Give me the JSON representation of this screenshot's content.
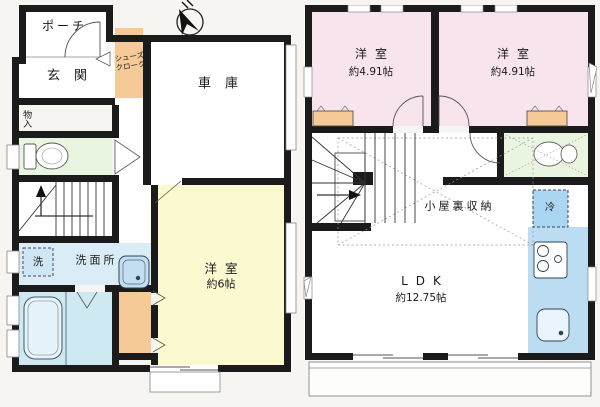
{
  "title": "住宅間取り図(1階・2階)",
  "compass": {
    "label": "N"
  },
  "floor1": {
    "porch": "ポーチ",
    "entrance": "玄関",
    "shoes_closet_line1": "シューズ",
    "shoes_closet_line2": "クローク",
    "garage": "車庫",
    "storage": "物入",
    "washer": "洗",
    "washroom": "洗面所",
    "western_room": "洋室",
    "western_room_size": "約6帖"
  },
  "floor2": {
    "western_room_left": "洋室",
    "western_room_left_size": "約4.91帖",
    "western_room_right": "洋室",
    "western_room_right_size": "約4.91帖",
    "attic_storage": "小屋裏収納",
    "refrigerator": "冷",
    "ldk": "LDK",
    "ldk_size": "約12.75帖"
  },
  "colors": {
    "wall": "#1b1b1b",
    "room_pink": "#f8e4ed",
    "room_yellow": "#fbf9d0",
    "closet_orange": "#f5ca96",
    "toilet_green": "#e9f5e1",
    "washroom_blue": "#daedf6",
    "bath_cyan": "#cfe9f2",
    "kitchen_blue": "#bcdcf2",
    "fridge_blue": "#abd6f1",
    "storage_yellow": "#f3d489",
    "background": "#f6f5f1"
  }
}
